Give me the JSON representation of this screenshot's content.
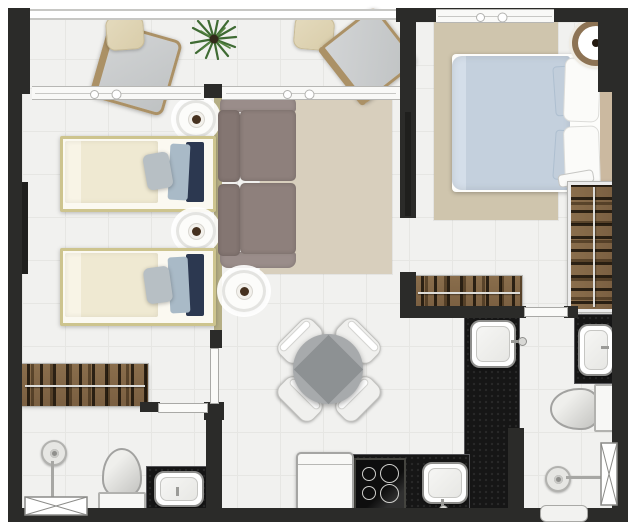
{
  "colors": {
    "wall": "#2b2b29",
    "floor": "#f1f1ef",
    "floor_line": "#e6e6e3",
    "divider_olive": "#b5ae85",
    "rug_living": "#d8cfbd",
    "rug_master": "#cfc5ad",
    "sofa": "#8f827f",
    "sofa_cushion": "#847672",
    "bed_frame": "#cdc48e",
    "duvet_cream": "#f1ecd7",
    "duvet_blue": "#c5d1de",
    "pillow_navy": "#2c3850",
    "headboard": "#cbb9a0",
    "wood_wardrobe": "#8a6e4c",
    "wood_frame": "#ab9166",
    "pouf_beige": "#d9cdaa",
    "counter_black": "#161616",
    "table_gray": "#a7aaac",
    "plant_green": "#3f6b33",
    "door_white": "#fafaf8"
  },
  "plan": {
    "type": "apartment-floor-plan",
    "rooms": [
      {
        "name": "balcony",
        "items": [
          "lounge-armchair",
          "ottoman",
          "potted-plant",
          "ottoman",
          "lounge-armchair",
          "railing",
          "sliding-windows"
        ]
      },
      {
        "name": "twin-bedroom",
        "items": [
          "twin-bed",
          "twin-bed",
          "round-nightstand",
          "round-nightstand",
          "wall-tv-panel",
          "open-wardrobe"
        ]
      },
      {
        "name": "living-room",
        "items": [
          "two-seat-sofa",
          "area-rug",
          "round-side-table",
          "dining-table",
          "dining-chair",
          "dining-chair",
          "dining-chair",
          "dining-chair"
        ]
      },
      {
        "name": "master-bedroom",
        "items": [
          "double-bed",
          "area-rug",
          "round-side-table",
          "open-wardrobe",
          "wall-shelf",
          "window"
        ]
      },
      {
        "name": "hallway",
        "items": [
          "open-wardrobe"
        ]
      },
      {
        "name": "kitchen",
        "items": [
          "l-shaped-counter",
          "sink",
          "sink",
          "cooktop-4-burners",
          "refrigerator"
        ]
      },
      {
        "name": "bathroom-left",
        "items": [
          "shower-head",
          "toilet",
          "vanity-sink",
          "crossed-window"
        ]
      },
      {
        "name": "bathroom-right",
        "items": [
          "shower-head",
          "toilet",
          "vanity-sink",
          "crossed-window",
          "threshold"
        ]
      }
    ]
  }
}
